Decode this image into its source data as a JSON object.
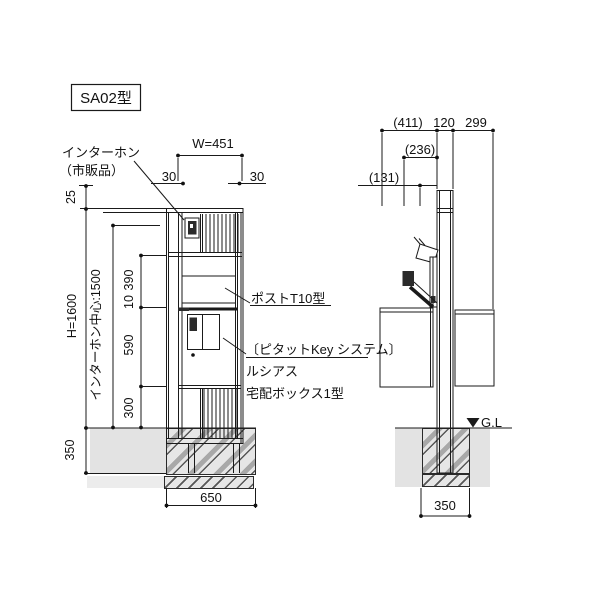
{
  "drawing": {
    "model_label": "SA02型",
    "front": {
      "intercom_label_line1": "インターホン",
      "intercom_label_line2": "（市販品）",
      "post_label": "ポストT10型",
      "delivery_label_line1": "〔ピタットKey システム〕",
      "delivery_label_line2": "ルシアス",
      "delivery_label_line3": "宅配ボックス1型",
      "dim_width": "W=451",
      "dim_left_rail": "30",
      "dim_right_rail": "30",
      "dim_top": "25",
      "dim_height": "H=1600",
      "dim_intercom_center": "インターホン中心:1500",
      "dim_seg1": "390",
      "dim_seg2": "10",
      "dim_seg3": "590",
      "dim_seg4": "300",
      "dim_foundation_depth": "350",
      "dim_foundation_width": "650"
    },
    "side": {
      "dim_front_overhang": "(411)",
      "dim_post_depth": "120",
      "dim_rear_overhang": "299",
      "dim_lid_projection": "(236)",
      "dim_intercom_projection": "(131)",
      "ground_level": "G.L",
      "dim_foundation_width": "350"
    },
    "icons": {
      "ground_level_marker": "filled-down-triangle"
    },
    "colors": {
      "line": "#1a1a1a",
      "soil": "#e3e3e3",
      "hatch_gray": "#a8a8a8",
      "hatch_dark": "#565656"
    }
  }
}
